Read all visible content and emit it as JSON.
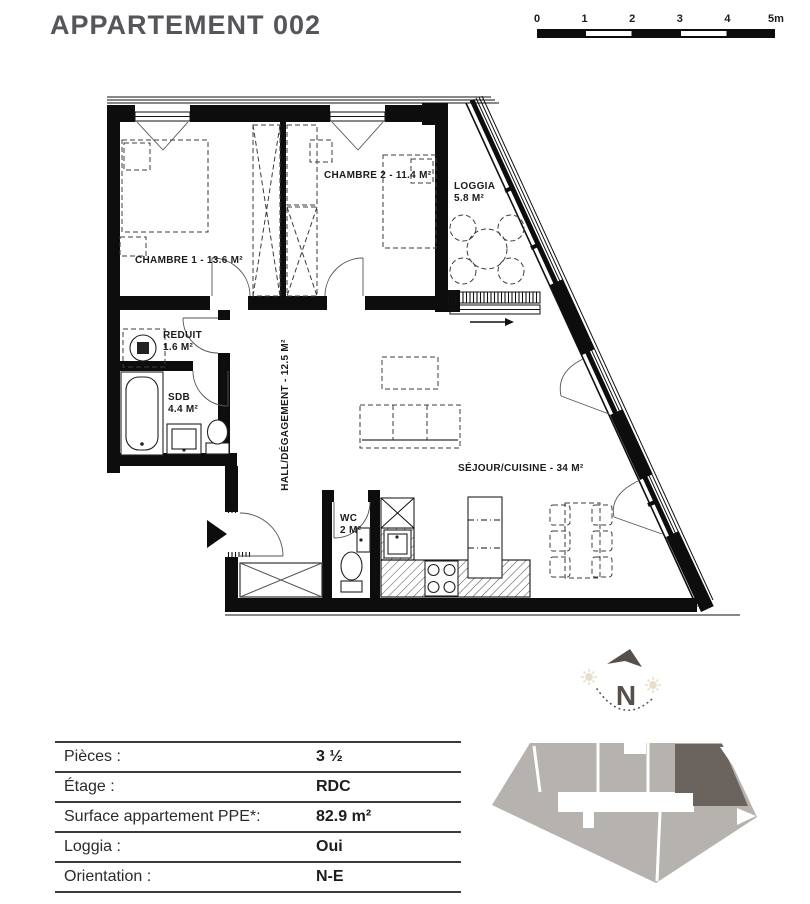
{
  "title": "APPARTEMENT 002",
  "scale_bar": {
    "ticks": [
      "0",
      "1",
      "2",
      "3",
      "4",
      "5m"
    ]
  },
  "plan": {
    "rooms": {
      "chambre1": "CHAMBRE 1 - 13.6 M²",
      "chambre2": "CHAMBRE 2 - 11.4 M²",
      "loggia_name": "LOGGIA",
      "loggia_area": "5.8 M²",
      "reduit_name": "REDUIT",
      "reduit_area": "1.6 M²",
      "sdb_name": "SDB",
      "sdb_area": "4.4 M²",
      "hall": "HALL/DÉGAGEMENT - 12.5 M²",
      "wc_name": "WC",
      "wc_area": "2 M²",
      "sejour": "SÉJOUR/CUISINE - 34 M²"
    }
  },
  "compass": {
    "label": "N"
  },
  "details_table": {
    "rows": [
      {
        "label": "Pièces :",
        "value": "3 ½"
      },
      {
        "label": "Étage :",
        "value": "RDC"
      },
      {
        "label": "Surface appartement PPE*:",
        "value": "82.9 m²"
      },
      {
        "label": "Loggia :",
        "value": "Oui"
      },
      {
        "label": "Orientation :",
        "value": "N-E"
      }
    ]
  },
  "colors": {
    "title_gray": "#56565a",
    "plan_black": "#0d0d0d",
    "keyplan_light": "#b6b2ae",
    "keyplan_dark": "#6a635e",
    "compass_dark": "#55504b",
    "sun_beige": "#e8dfca"
  }
}
